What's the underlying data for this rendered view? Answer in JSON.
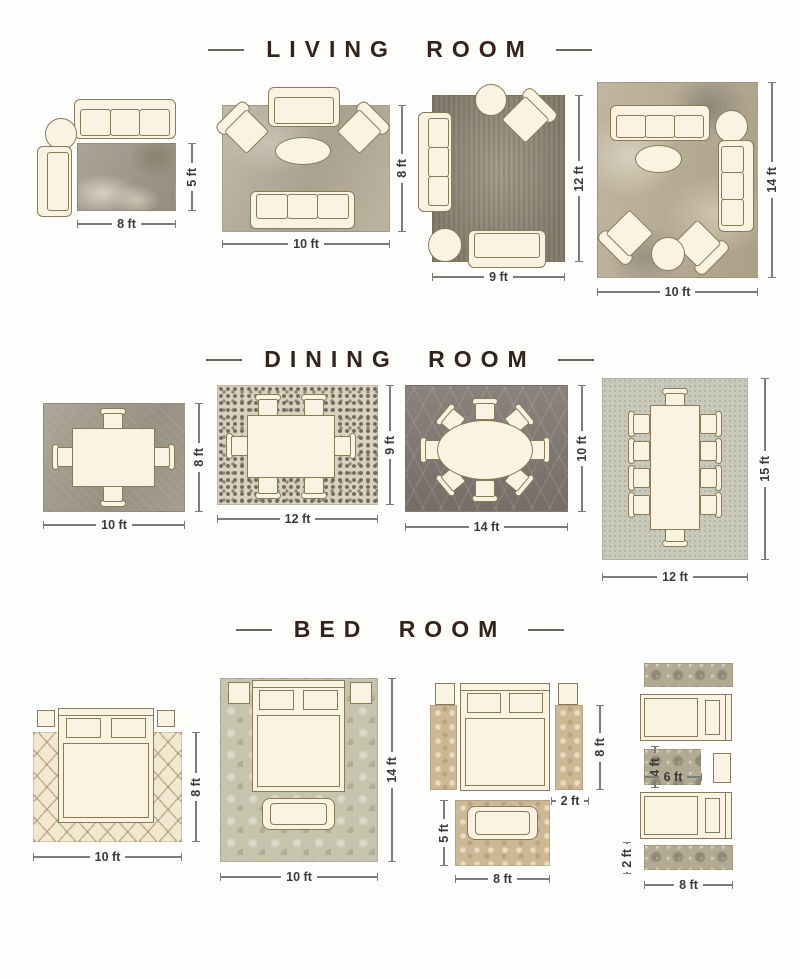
{
  "colors": {
    "title_text": "#33231a",
    "dimension_text": "#3a3a38",
    "furniture_fill": "#faf3e1",
    "furniture_outline": "#8b7a57"
  },
  "sections": [
    {
      "title": "LIVING ROOM",
      "layouts": [
        {
          "dim_w": "8 ft",
          "dim_h": "5 ft"
        },
        {
          "dim_w": "10 ft",
          "dim_h": "8 ft"
        },
        {
          "dim_w": "9 ft",
          "dim_h": "12 ft"
        },
        {
          "dim_w": "10 ft",
          "dim_h": "14 ft"
        }
      ]
    },
    {
      "title": "DINING ROOM",
      "layouts": [
        {
          "dim_w": "10 ft",
          "dim_h": "8 ft"
        },
        {
          "dim_w": "12 ft",
          "dim_h": "9 ft"
        },
        {
          "dim_w": "14 ft",
          "dim_h": "10 ft"
        },
        {
          "dim_w": "12 ft",
          "dim_h": "15 ft"
        }
      ]
    },
    {
      "title": "BED ROOM",
      "layouts": [
        {
          "dim_w": "10 ft",
          "dim_h": "8 ft"
        },
        {
          "dim_w": "10 ft",
          "dim_h": "14 ft"
        },
        {
          "dim_side_h": "8 ft",
          "dim_runner_w": "2 ft",
          "dim_bench_h": "5 ft",
          "dim_w": "8 ft"
        },
        {
          "dim_mid_h": "4 ft",
          "dim_mid_w": "6 ft",
          "dim_runner_h": "2 ft",
          "dim_w": "8 ft"
        }
      ]
    }
  ]
}
